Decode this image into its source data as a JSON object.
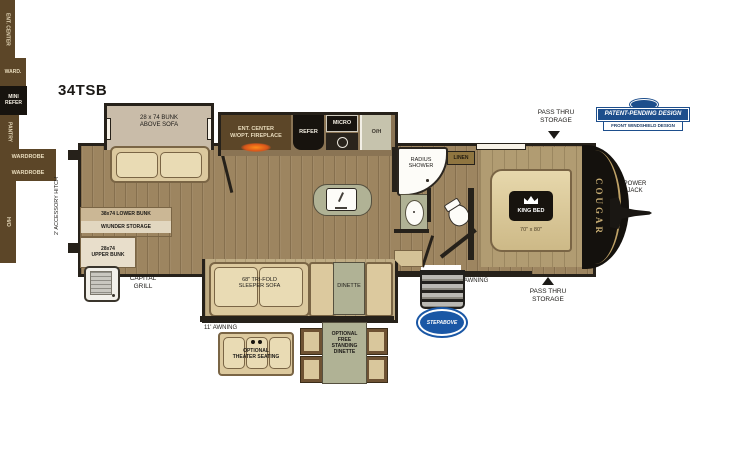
{
  "model": "34TSB",
  "badge": {
    "title": "PATENT-PENDING DESIGN",
    "subtitle": "FRONT WINDSHIELD DESIGN"
  },
  "brand": {
    "name": "COUGAR",
    "step_logo": "STEPABOVE"
  },
  "exterior_labels": {
    "accessory_hitch": "2' ACCESSORY HITCH",
    "capital_grill": "CAPITAL\nGRILL",
    "awning_rear": "11' AWNING",
    "awning_front": "8' AWNING",
    "pass_thru_top": "PASS THRU\nSTORAGE",
    "pass_thru_bottom": "PASS THRU\nSTORAGE",
    "power_jack": "POWER\nJACK"
  },
  "interior_labels": {
    "bunk_slide": "28 x 74 BUNK\nABOVE SOFA",
    "rear_ent_center": "ENT. CENTER",
    "lower_bunk": "38x74 LOWER BUNK",
    "lower_bunk_storage": "W/UNDER STORAGE",
    "upper_bunk": "28x74\nUPPER BUNK",
    "mini_refer": "MINI\nREFER",
    "wardrobe_small": "WARD.",
    "pantry": "PANTRY",
    "ent_center_fireplace": "ENT. CENTER\nW/OPT. FIREPLACE",
    "refer": "REFER",
    "micro": "MICRO",
    "overhead": "O/H",
    "radius_shower": "RADIUS\nSHOWER",
    "linen": "LINEN",
    "wardrobe_top": "WARDROBE",
    "wardrobe_bottom": "WARDROBE",
    "king_bed": "KING BED",
    "king_bed_size": "70\" x 80\"",
    "hutch": "H/O",
    "sleeper_sofa": "68\" TRI-FOLD\nSLEEPER SOFA",
    "dinette": "DINETTE",
    "theater_seating": "OPTIONAL\nTHEATER SEATING",
    "free_standing_dinette": "OPTIONAL\nFREE\nSTANDING\nDINETTE"
  },
  "colors": {
    "outline": "#26211a",
    "cabinet_brown": "#5c4628",
    "floor_tan": "#9d8560",
    "furniture_tan": "#dcc99e",
    "sage_green": "#b0b295",
    "appliance_black": "#17130e",
    "badge_blue": "#1d4e8c",
    "step_logo_blue": "#1a57a5",
    "cougar_gold": "#c4a96f",
    "fireplace_orange": "#ff8c1a"
  }
}
